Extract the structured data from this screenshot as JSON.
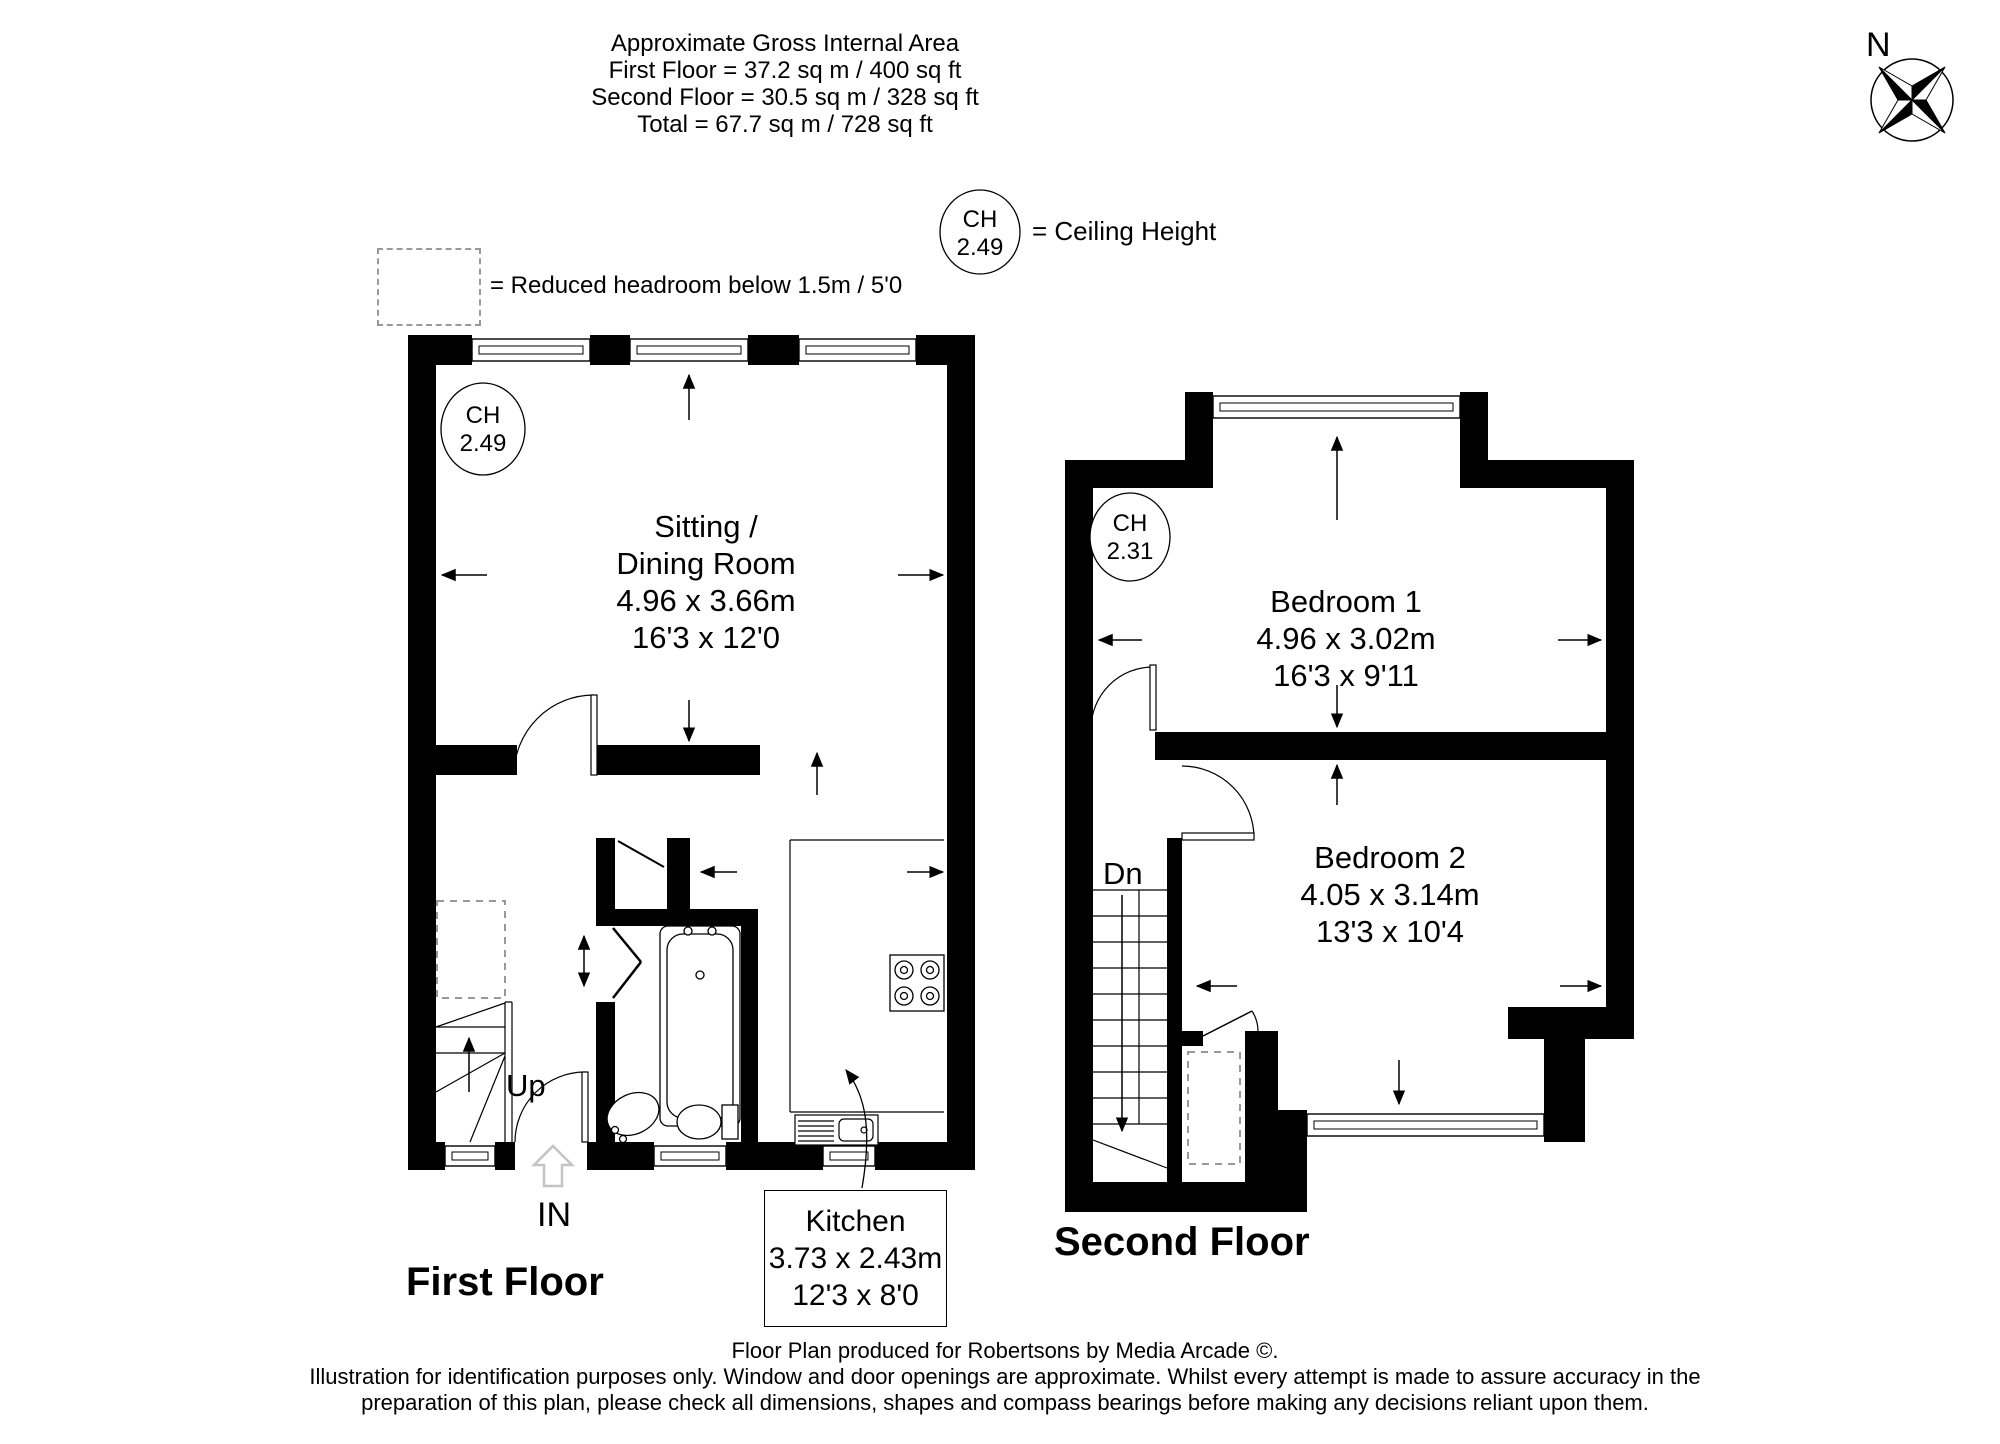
{
  "header": {
    "line1": "Approximate Gross Internal Area",
    "line2": "First Floor = 37.2 sq m / 400 sq ft",
    "line3": "Second Floor = 30.5 sq m / 328 sq ft",
    "line4": "Total = 67.7 sq m / 728 sq ft"
  },
  "compass": {
    "north_label": "N"
  },
  "legend": {
    "reduced_headroom_label": "= Reduced headroom below 1.5m / 5'0",
    "ceiling_height_abbr": "CH",
    "ceiling_height_value": "2.49",
    "ceiling_height_label": "= Ceiling Height"
  },
  "first_floor": {
    "title": "First Floor",
    "ceiling_height_abbr": "CH",
    "ceiling_height_value": "2.49",
    "sitting_dining": {
      "name_line1": "Sitting /",
      "name_line2": "Dining Room",
      "dims_metric": "4.96 x 3.66m",
      "dims_imperial": "16'3 x 12'0"
    },
    "kitchen": {
      "name": "Kitchen",
      "dims_metric": "3.73 x 2.43m",
      "dims_imperial": "12'3 x 8'0"
    },
    "stairs_label": "Up",
    "entrance_label": "IN"
  },
  "second_floor": {
    "title": "Second Floor",
    "ceiling_height_abbr": "CH",
    "ceiling_height_value": "2.31",
    "bedroom1": {
      "name": "Bedroom 1",
      "dims_metric": "4.96 x 3.02m",
      "dims_imperial": "16'3 x 9'11"
    },
    "bedroom2": {
      "name": "Bedroom 2",
      "dims_metric": "4.05 x 3.14m",
      "dims_imperial": "13'3 x 10'4"
    },
    "stairs_label": "Dn"
  },
  "footer": {
    "line1": "Floor Plan produced for Robertsons by Media Arcade ©.",
    "line2": "Illustration for identification purposes only. Window and door openings are approximate. Whilst every attempt is made to assure accuracy in the",
    "line3": "preparation of this plan, please check all dimensions, shapes and compass bearings before making any decisions reliant upon them."
  },
  "colors": {
    "wall": "#000000",
    "reduced_headroom_dash": "#999999",
    "entry_arrow_gray": "#c4c4c4"
  }
}
